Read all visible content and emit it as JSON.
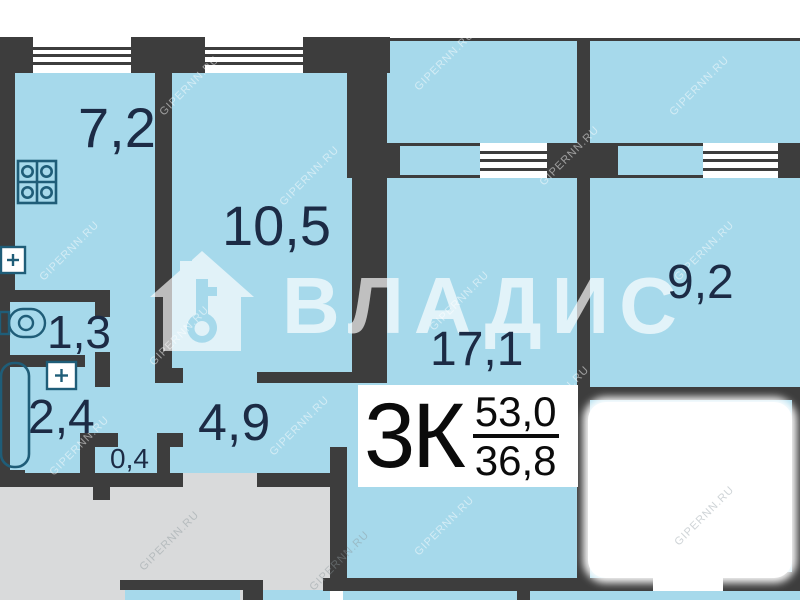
{
  "plan": {
    "title": "apartment floor plan",
    "rooms": {
      "kitchen": {
        "name": "kitchen",
        "area": "7,2"
      },
      "room_105": {
        "name": "room",
        "area": "10,5"
      },
      "wc": {
        "name": "wc",
        "area": "1,3"
      },
      "bathroom": {
        "name": "bathroom",
        "area": "2,4"
      },
      "closet": {
        "name": "closet",
        "area": "0,4"
      },
      "hallway": {
        "name": "hallway",
        "area": "4,9"
      },
      "living_room": {
        "name": "living room",
        "area": "17,1"
      },
      "bedroom": {
        "name": "bedroom",
        "area": "9,2"
      }
    },
    "info_box": {
      "type_label": "3К",
      "total_area": "53,0",
      "living_area": "36,8"
    },
    "watermark": {
      "brand": "ВЛАДИС",
      "site": "GIPERNN.RU"
    },
    "icons": {
      "stove": "stove-icon",
      "kitchen_sink": "sink-icon",
      "toilet": "toilet-icon",
      "bath_sink": "sink-icon",
      "bathtub": "bathtub-icon",
      "logo_house": "house-key-icon"
    },
    "colors": {
      "room_fill": "#a6d9eb",
      "wall": "#3d3d3d",
      "stair_gray": "#d9dadb",
      "label_text": "#1c2b45",
      "fixture_stroke": "#1f5d78",
      "info_text": "#0b0b0b"
    }
  }
}
